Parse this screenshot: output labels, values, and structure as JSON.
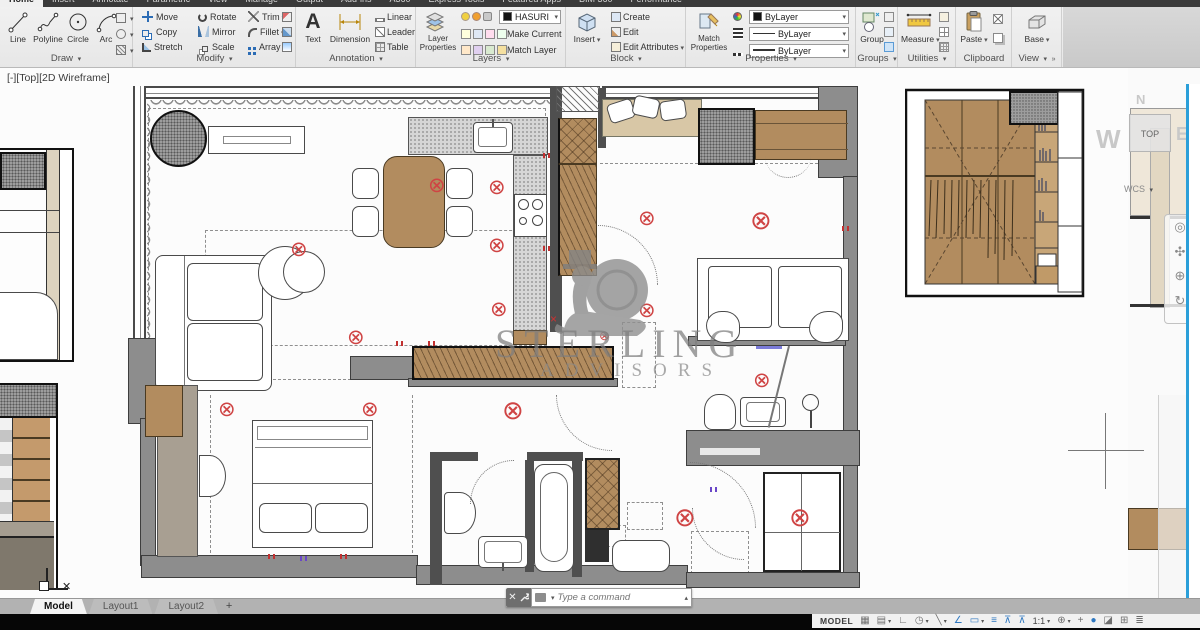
{
  "ribbon": {
    "arrow": "▾",
    "overflow": "»",
    "tabs": [
      "Home",
      "Insert",
      "Annotate",
      "Parametric",
      "View",
      "Manage",
      "Output",
      "Add-ins",
      "A360",
      "Express Tools",
      "Featured Apps",
      "BIM 360",
      "Performance"
    ],
    "draw": {
      "label": "Draw",
      "items": [
        "Line",
        "Polyline",
        "Circle",
        "Arc"
      ]
    },
    "modify": {
      "label": "Modify",
      "items": [
        "Move",
        "Copy",
        "Stretch",
        "Rotate",
        "Mirror",
        "Scale",
        "Trim",
        "Fillet",
        "Array"
      ]
    },
    "annotation": {
      "label": "Annotation",
      "items": [
        "Text",
        "Dimension",
        "Linear",
        "Leader",
        "Table"
      ]
    },
    "layers": {
      "label": "Layers",
      "big": "Layer Properties",
      "dropdown": "HASURI",
      "make_current": "Make Current",
      "match_layer": "Match Layer"
    },
    "block": {
      "label": "Block",
      "big": "Insert",
      "items": [
        "Create",
        "Edit",
        "Edit Attributes"
      ]
    },
    "properties": {
      "label": "Properties",
      "big": "Match Properties",
      "color": "ByLayer",
      "linetype": "ByLayer",
      "lineweight": "ByLayer"
    },
    "groups": {
      "label": "Groups",
      "big": "Group"
    },
    "utilities": {
      "label": "Utilities",
      "big": "Measure"
    },
    "clipboard": {
      "label": "Clipboard",
      "big": "Paste"
    },
    "view": {
      "label": "View",
      "big": "Base"
    }
  },
  "viewport": {
    "label": "[-][Top][2D Wireframe]",
    "min": "‒",
    "restore": "□",
    "close": "✕"
  },
  "watermark": {
    "line1": "STERLING",
    "line2": "ADVISORS"
  },
  "viewcube": {
    "n": "N",
    "w": "W",
    "e": "E",
    "top": "TOP",
    "wcs": "WCS"
  },
  "command": {
    "placeholder": "Type a command",
    "close": "✕",
    "open": "▴"
  },
  "layout_tabs": {
    "items": [
      "Model",
      "Layout1",
      "Layout2"
    ],
    "add": "+"
  },
  "status": {
    "model": "MODEL",
    "scale": "1:1",
    "icons": [
      "▦",
      "▤",
      "∟",
      "◷",
      "╲",
      "∠",
      "▭",
      "≡",
      "⊼",
      "⊼",
      "⊕",
      "+",
      "●",
      "◪",
      "⊞",
      "≣"
    ]
  },
  "plan": {
    "light": "⊗",
    "ucs_x": "✕"
  }
}
